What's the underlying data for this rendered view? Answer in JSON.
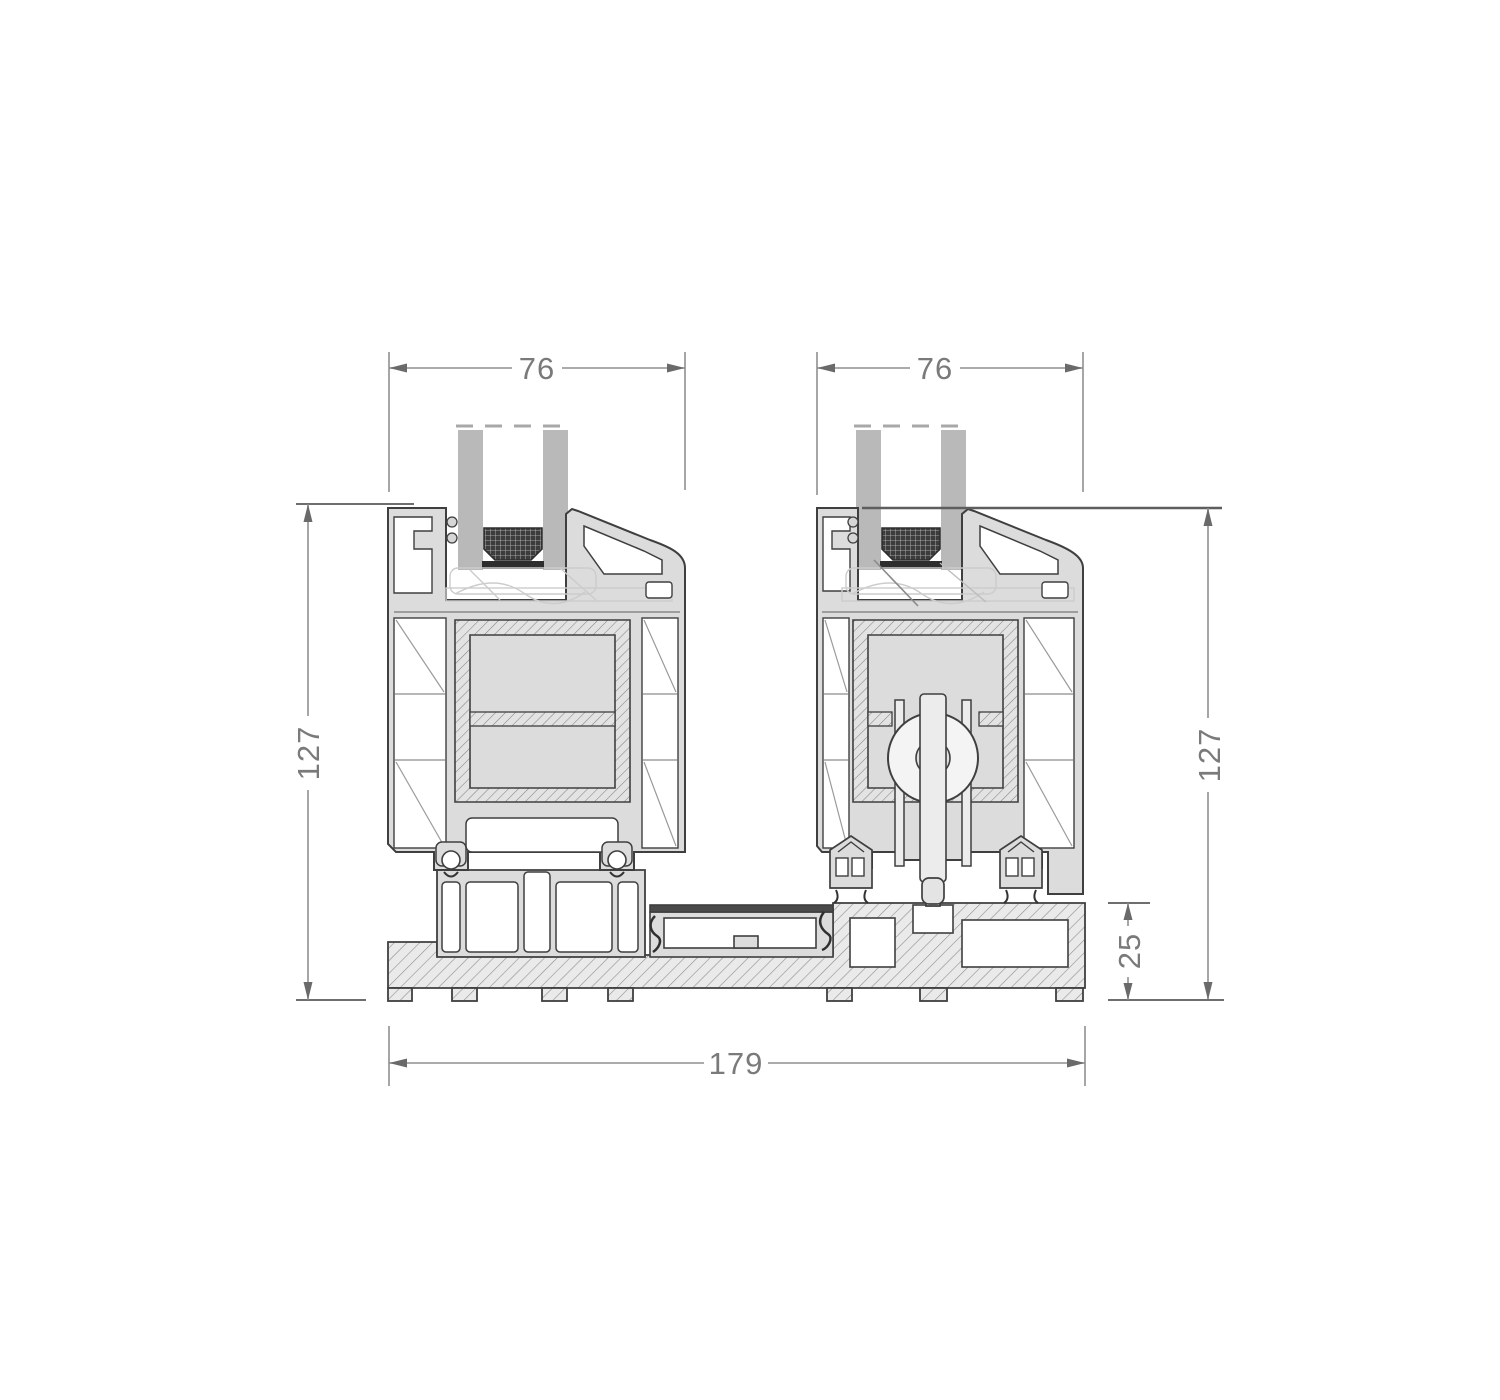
{
  "diagram": {
    "type": "technical-cross-section",
    "subject": "sliding-door-sill-profiles",
    "dims": {
      "d76_left": "76",
      "d76_right": "76",
      "d127_left": "127",
      "d127_right": "127",
      "d25": "25",
      "d179": "179"
    },
    "style": {
      "background": "#ffffff",
      "outline_color": "#3f3f3f",
      "profile_fill": "#dcdcdc",
      "glass_fill": "#b9b9b9",
      "spacer_fill": "#3c3c3c",
      "hatch_line": "#8a8a8a",
      "dim_line_color": "#8f8f8f",
      "dim_text_color": "#7a7a7a"
    }
  }
}
